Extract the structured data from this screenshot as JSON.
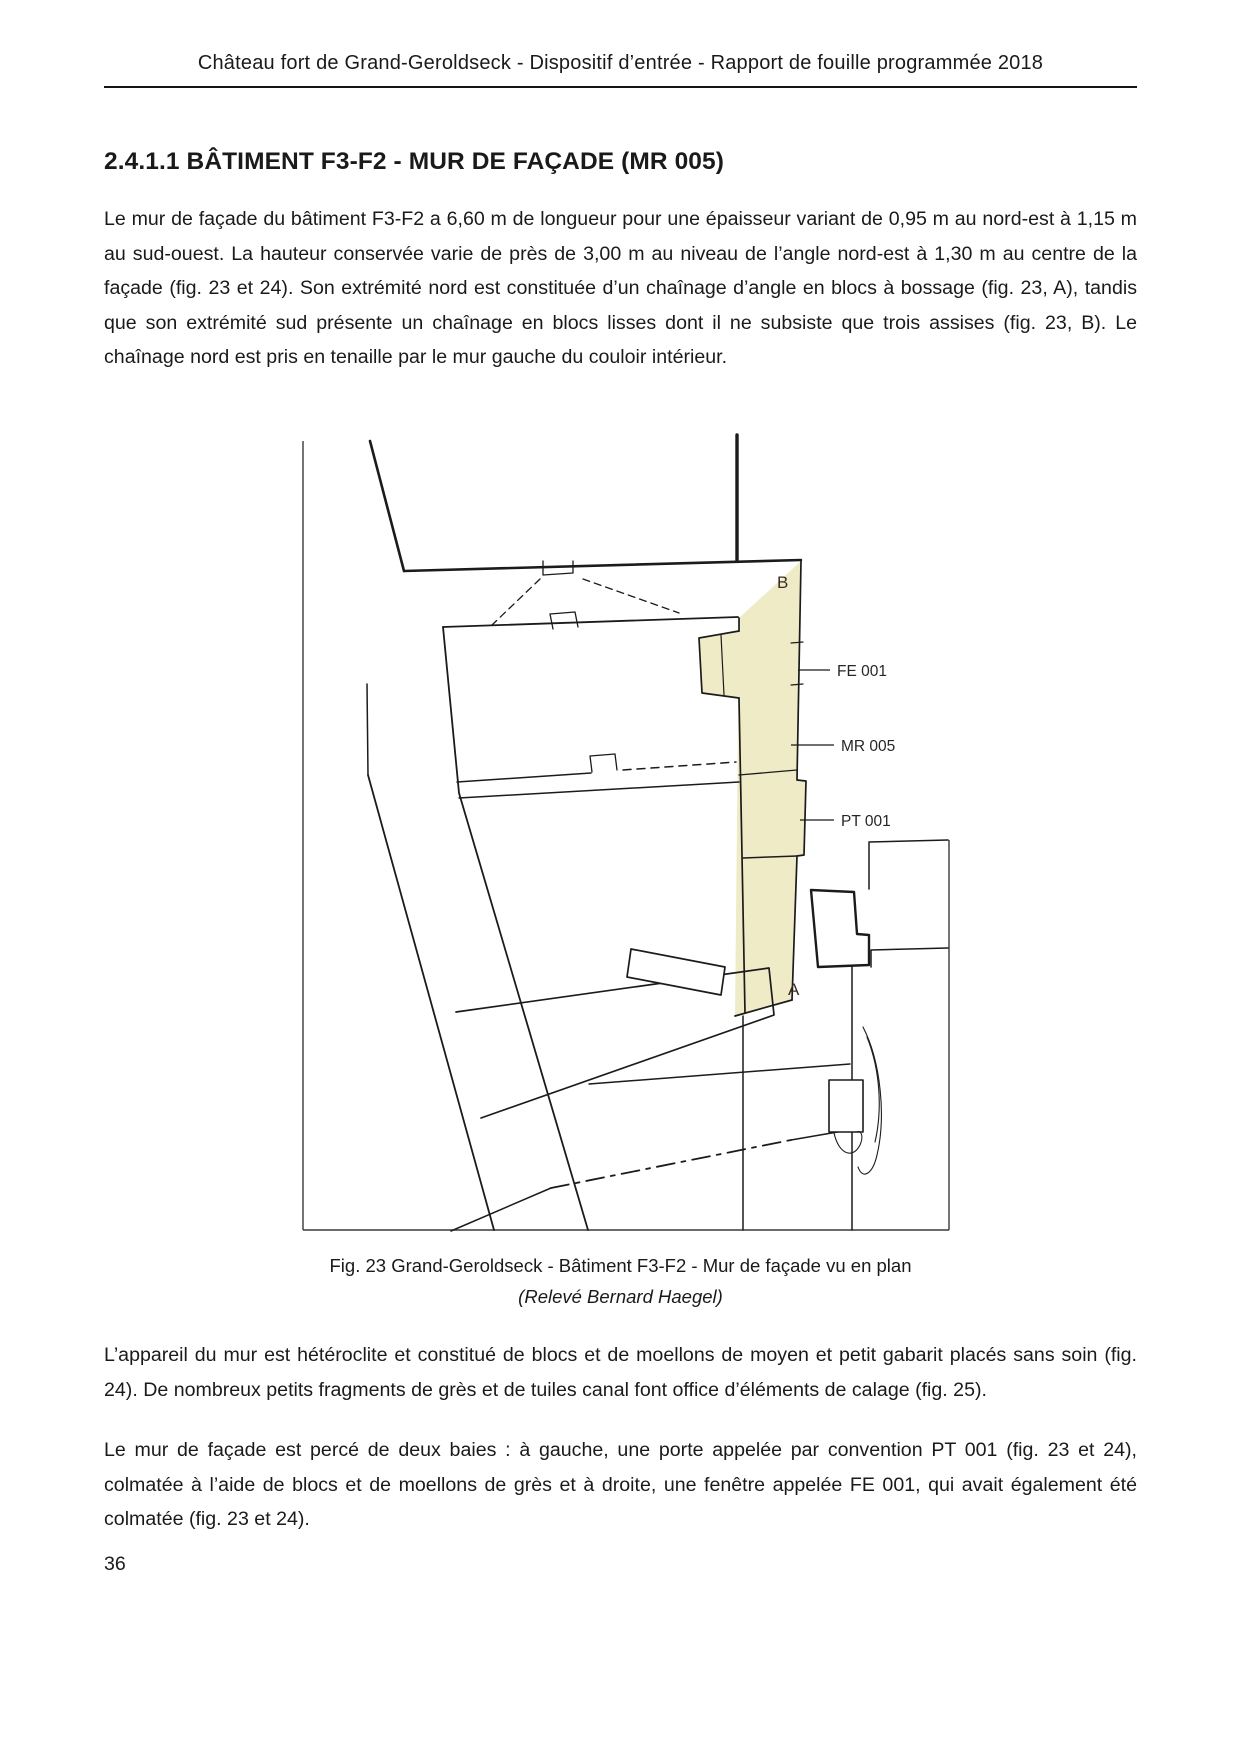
{
  "page": {
    "header": "Château fort de Grand-Geroldseck - Dispositif d’entrée - Rapport de fouille programmée 2018",
    "section_heading": "2.4.1.1 BÂTIMENT F3-F2 - MUR DE FAÇADE (MR 005)",
    "paragraph_1": "Le mur de façade du bâtiment F3-F2 a 6,60 m de longueur pour une épaisseur variant de 0,95 m au nord-est à 1,15 m au sud-ouest. La hauteur conservée varie de près de 3,00 m au niveau de l’angle nord-est à 1,30 m au centre de la façade (fig. 23 et 24). Son extrémité nord est constituée d’un chaînage d’angle en blocs à bossage (fig. 23, A), tandis que son extrémité sud présente un chaînage en blocs lisses dont il ne subsiste que trois assises (fig. 23, B). Le chaînage nord est pris en tenaille par le mur gauche du couloir intérieur.",
    "figure": {
      "labels": {
        "corner_b": "B",
        "corner_a": "A",
        "window": "FE 001",
        "wall": "MR 005",
        "door": "PT 001"
      },
      "highlight_color": "#f0ebc7",
      "caption": "Fig. 23 Grand-Geroldseck - Bâtiment F3-F2 - Mur de façade vu en plan",
      "credit": "(Relevé Bernard Haegel)"
    },
    "paragraph_2": "L’appareil du mur est hétéroclite et constitué de blocs et de moellons de moyen et petit gabarit placés sans soin (fig. 24). De nombreux petits fragments de grès et de tuiles canal font office d’éléments de calage (fig. 25).",
    "paragraph_3": "Le mur de façade est percé de deux baies : à gauche, une porte appelée par convention PT 001 (fig. 23 et 24), colmatée à l’aide de blocs et de moellons de grès et à droite, une fenêtre appelée FE 001, qui avait également été colmatée (fig. 23 et 24).",
    "page_number": "36"
  }
}
